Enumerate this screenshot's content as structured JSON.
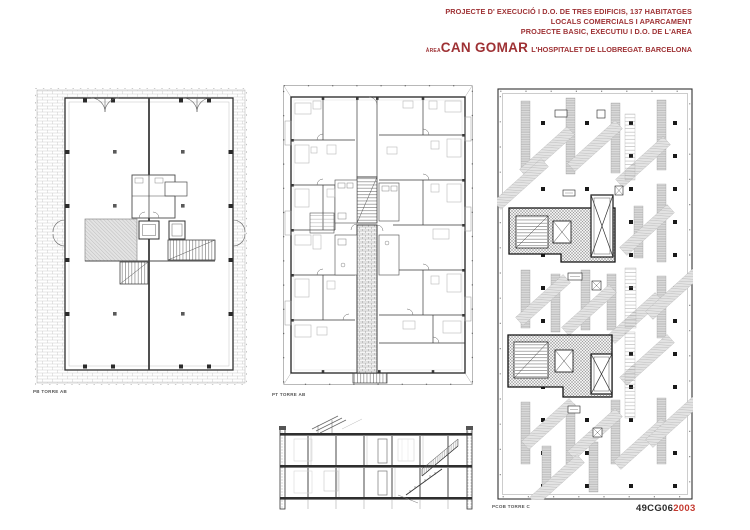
{
  "colors": {
    "accent": "#9e3134",
    "year": "#c43a30",
    "label": "#555555"
  },
  "header": {
    "line1": "PROJECTE D' EXECUCIÓ I D.O. DE TRES EDIFICIS, 137 HABITATGES",
    "line2": "LOCALS COMERCIALS I APARCAMENT",
    "line3": "PROJECTE BASIC, EXECUTIU I D.O. DE L'AREA",
    "area_prefix": "ÀREA",
    "project_name": "CAN GOMAR",
    "location": "L'HOSPITALET DE LLOBREGAT. BARCELONA"
  },
  "plans": {
    "ground": {
      "label": "PB TORRE AB"
    },
    "typical": {
      "label": "PT TORRE AB"
    },
    "roof": {
      "label": "PCOB TORRE C"
    }
  },
  "titleblock": {
    "code": "49CG06",
    "year": "2003"
  }
}
